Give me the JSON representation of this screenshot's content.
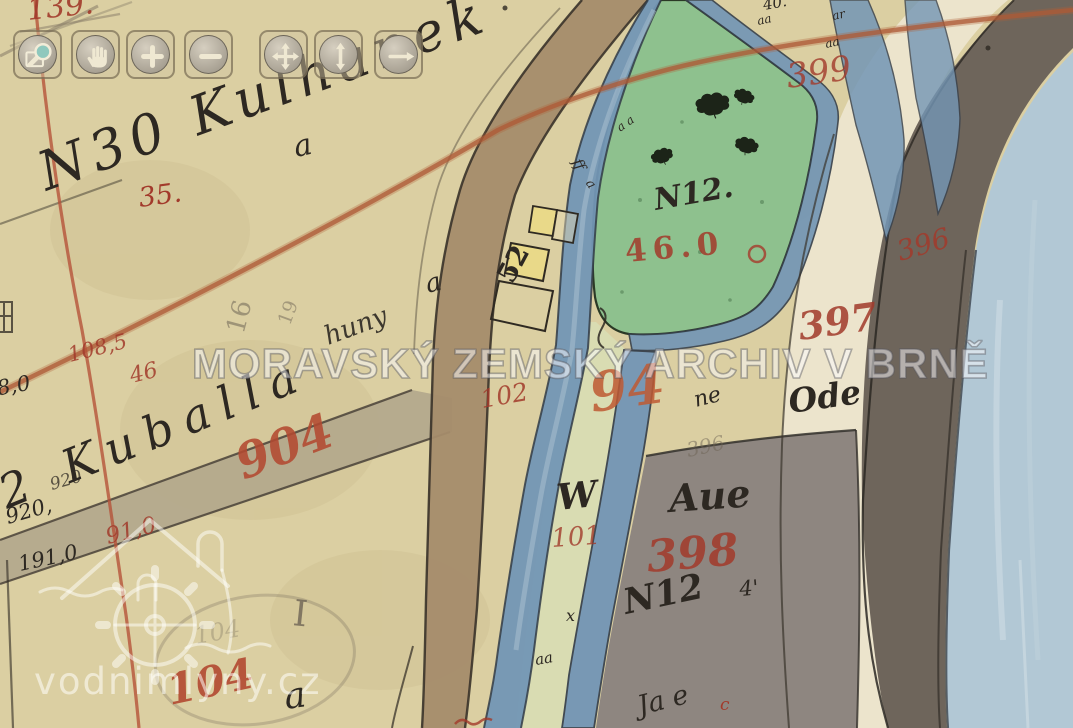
{
  "viewer": {
    "toolbar": {
      "buttons": [
        {
          "icon": "zoom-region-icon"
        },
        {
          "icon": "pan-hand-icon"
        },
        {
          "icon": "zoom-in-icon"
        },
        {
          "icon": "zoom-out-icon"
        },
        {
          "icon": "move-icon"
        },
        {
          "icon": "pan-vertical-icon"
        },
        {
          "icon": "pan-horizontal-icon"
        }
      ]
    }
  },
  "watermarks": {
    "archive_text": "MORAVSKÝ ZEMSKÝ ARCHIV V BRNĚ",
    "site_text": "vodnimlyny.cz"
  },
  "map": {
    "colors": {
      "paper": "#dbcfa2",
      "meadow_green": "#8cc18e",
      "strip_green": "#d9dcb2",
      "stream_blue": "#7396b5",
      "river_blue": "#b2c8d5",
      "road_brown": "#a58c6c",
      "road_gray": "#b3a88c",
      "parcel_gray": "#8e8680",
      "band_dark": "#6e655b",
      "cream": "#ece4cc",
      "building_yellow": "#e9d989",
      "ink": "#2d2822",
      "red_ink": "#a23a2b",
      "red_large": "#b34a31",
      "orange_ink": "#bf5a33"
    },
    "labels": [
      {
        "t": "139.",
        "x": 28,
        "y": 26,
        "s": 30,
        "c": "#a23a2b",
        "r": -6,
        "i": 1,
        "o": 0.9
      },
      {
        "t": "N30 Kulhanek",
        "x": 46,
        "y": 200,
        "s": 54,
        "c": "#2d2822",
        "r": -20,
        "i": 1,
        "ls": 7
      },
      {
        "t": "a",
        "x": 296,
        "y": 163,
        "s": 30,
        "c": "#2d2822",
        "r": -12,
        "i": 1
      },
      {
        "t": "35.",
        "x": 140,
        "y": 212,
        "s": 27,
        "c": "#a23a2b",
        "r": -8,
        "i": 1
      },
      {
        "t": "16",
        "x": 243,
        "y": 340,
        "s": 26,
        "c": "#6e6455",
        "r": -75,
        "o": 0.55
      },
      {
        "t": "19",
        "x": 290,
        "y": 330,
        "s": 19,
        "c": "#6e6455",
        "r": -70,
        "o": 0.5
      },
      {
        "t": "huny",
        "x": 328,
        "y": 350,
        "s": 26,
        "c": "#2d2822",
        "r": -20,
        "i": 1,
        "o": 0.9
      },
      {
        "t": "a",
        "x": 428,
        "y": 298,
        "s": 26,
        "c": "#2d2822",
        "r": -15,
        "i": 1
      },
      {
        "t": "2 Kuballa",
        "x": 6,
        "y": 516,
        "s": 46,
        "c": "#2d2822",
        "r": -22,
        "i": 1,
        "ls": 12
      },
      {
        "t": "108,5",
        "x": 70,
        "y": 366,
        "s": 21,
        "c": "#a23a2b",
        "r": -14,
        "i": 1,
        "o": 0.85
      },
      {
        "t": "46",
        "x": 132,
        "y": 388,
        "s": 22,
        "c": "#a23a2b",
        "r": -14,
        "i": 1,
        "o": 0.85
      },
      {
        "t": "908,0",
        "x": -28,
        "y": 404,
        "s": 21,
        "c": "#2d2822",
        "r": -10,
        "i": 1
      },
      {
        "t": "920,",
        "x": 8,
        "y": 528,
        "s": 21,
        "c": "#2d2822",
        "r": -16,
        "i": 1
      },
      {
        "t": "920",
        "x": 52,
        "y": 494,
        "s": 17,
        "c": "#2d2822",
        "r": -16,
        "i": 1,
        "o": 0.75
      },
      {
        "t": "91,0",
        "x": 108,
        "y": 549,
        "s": 23,
        "c": "#a23a2b",
        "r": -14,
        "i": 1,
        "o": 0.85
      },
      {
        "t": "191,0",
        "x": 20,
        "y": 575,
        "s": 21,
        "c": "#2d2822",
        "r": -12,
        "i": 1
      },
      {
        "t": "904",
        "x": 243,
        "y": 488,
        "s": 48,
        "c": "#b34a31",
        "r": -21,
        "i": 1,
        "w": 700,
        "o": 0.88
      },
      {
        "t": "I",
        "x": 292,
        "y": 632,
        "s": 36,
        "c": "#6e6455",
        "r": 6,
        "o": 0.8
      },
      {
        "t": "104",
        "x": 170,
        "y": 712,
        "s": 42,
        "c": "#b34a31",
        "r": -12,
        "i": 1,
        "w": 700,
        "o": 0.9
      },
      {
        "t": "104",
        "x": 196,
        "y": 648,
        "s": 24,
        "c": "#6e6455",
        "r": -10,
        "i": 1,
        "o": 0.3
      },
      {
        "t": "a",
        "x": 286,
        "y": 716,
        "s": 36,
        "c": "#2d2822",
        "r": -8,
        "i": 1
      },
      {
        "t": "52",
        "x": 512,
        "y": 290,
        "s": 27,
        "c": "#2d2822",
        "r": -62,
        "w": 600
      },
      {
        "t": "ff",
        "x": 572,
        "y": 165,
        "s": 15,
        "c": "#2d2822",
        "r": 62,
        "i": 1
      },
      {
        "t": "a",
        "x": 585,
        "y": 186,
        "s": 13,
        "c": "#2d2822",
        "r": 55,
        "i": 1
      },
      {
        "t": "a a",
        "x": 620,
        "y": 134,
        "s": 12,
        "c": "#2d2822",
        "r": -35,
        "i": 1
      },
      {
        "t": "N12.",
        "x": 656,
        "y": 216,
        "s": 30,
        "c": "#2d2822",
        "r": -10,
        "i": 1,
        "w": 600
      },
      {
        "t": "46.0",
        "x": 626,
        "y": 268,
        "s": 31,
        "c": "#a23a2b",
        "r": -5,
        "ls": 6,
        "w": 600,
        "o": 0.85
      },
      {
        "t": "399",
        "x": 788,
        "y": 94,
        "s": 34,
        "c": "#a23a2b",
        "r": -8,
        "i": 1,
        "o": 0.8
      },
      {
        "t": "40.",
        "x": 764,
        "y": 13,
        "s": 15,
        "c": "#2d2822",
        "r": -10,
        "i": 1
      },
      {
        "t": "aa",
        "x": 758,
        "y": 27,
        "s": 12,
        "c": "#2d2822",
        "r": -12,
        "i": 1
      },
      {
        "t": "ar",
        "x": 833,
        "y": 22,
        "s": 12,
        "c": "#2d2822",
        "r": -12,
        "i": 1
      },
      {
        "t": "aa",
        "x": 826,
        "y": 50,
        "s": 12,
        "c": "#2d2822",
        "r": -12,
        "i": 1
      },
      {
        "t": "396",
        "x": 900,
        "y": 266,
        "s": 28,
        "c": "#a23a2b",
        "r": -16,
        "i": 1,
        "o": 0.85
      },
      {
        "t": "397",
        "x": 800,
        "y": 346,
        "s": 38,
        "c": "#a23a2b",
        "r": -8,
        "i": 1,
        "w": 600,
        "o": 0.85
      },
      {
        "t": "Ode",
        "x": 790,
        "y": 418,
        "s": 33,
        "c": "#2d2822",
        "r": -8,
        "i": 1,
        "w": 600
      },
      {
        "t": "ne",
        "x": 696,
        "y": 412,
        "s": 22,
        "c": "#2d2822",
        "r": -14,
        "i": 1
      },
      {
        "t": "94",
        "x": 592,
        "y": 420,
        "s": 54,
        "c": "#bf5a33",
        "r": -8,
        "i": 1,
        "w": 700,
        "o": 0.85
      },
      {
        "t": "102",
        "x": 482,
        "y": 412,
        "s": 25,
        "c": "#a23a2b",
        "r": -10,
        "i": 1,
        "o": 0.85
      },
      {
        "t": "396",
        "x": 688,
        "y": 460,
        "s": 20,
        "c": "#6e6455",
        "r": -12,
        "i": 1,
        "o": 0.5
      },
      {
        "t": "W",
        "x": 558,
        "y": 516,
        "s": 36,
        "c": "#2d2822",
        "r": -6,
        "i": 1,
        "w": 600
      },
      {
        "t": "101",
        "x": 552,
        "y": 552,
        "s": 26,
        "c": "#a23a2b",
        "r": -4,
        "i": 1,
        "o": 0.8
      },
      {
        "t": "Aue",
        "x": 670,
        "y": 518,
        "s": 38,
        "c": "#2d2822",
        "r": -4,
        "i": 1,
        "w": 600
      },
      {
        "t": "398",
        "x": 648,
        "y": 580,
        "s": 44,
        "c": "#a23a2b",
        "r": -5,
        "i": 1,
        "w": 600,
        "o": 0.85
      },
      {
        "t": "N12",
        "x": 626,
        "y": 620,
        "s": 35,
        "c": "#2d2822",
        "r": -12,
        "i": 1,
        "w": 600
      },
      {
        "t": "4'",
        "x": 740,
        "y": 600,
        "s": 21,
        "c": "#2d2822",
        "r": -5,
        "i": 1
      },
      {
        "t": "x",
        "x": 566,
        "y": 624,
        "s": 16,
        "c": "#2d2822",
        "i": 1
      },
      {
        "t": "aa",
        "x": 536,
        "y": 668,
        "s": 15,
        "c": "#2d2822",
        "r": -10,
        "i": 1
      },
      {
        "t": "Ja e",
        "x": 640,
        "y": 720,
        "s": 27,
        "c": "#2d2822",
        "r": -14,
        "i": 1
      },
      {
        "t": "c",
        "x": 720,
        "y": 714,
        "s": 17,
        "c": "#a23a2b",
        "i": 1
      }
    ]
  }
}
